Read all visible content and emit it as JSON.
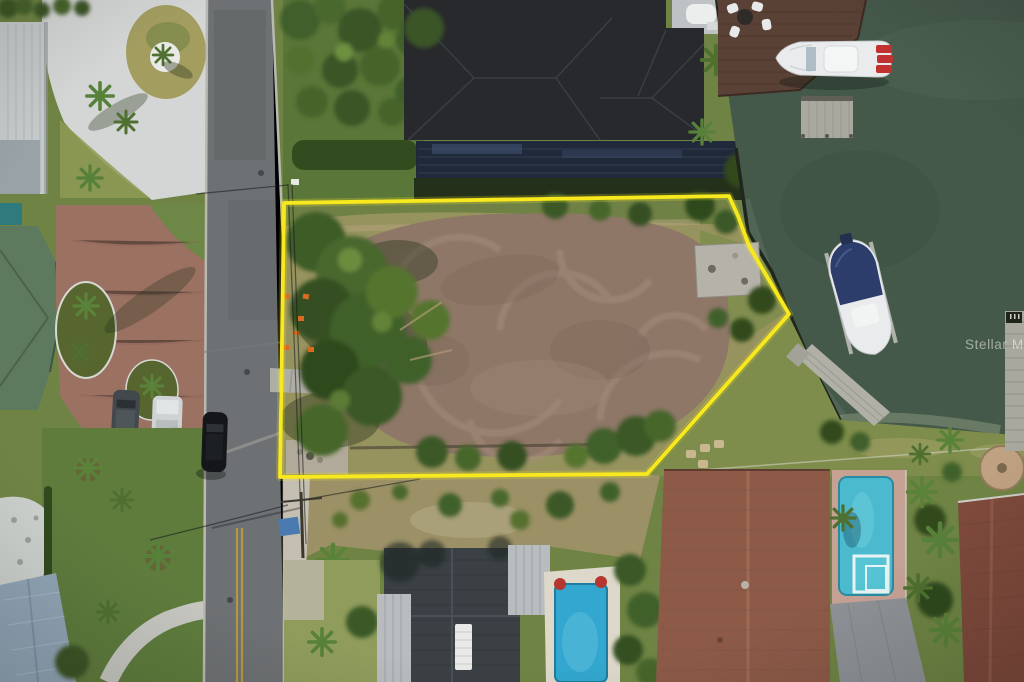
{
  "meta": {
    "description": "Aerial drone photograph of a cleared vacant waterfront lot outlined in yellow, bordered by a residential street on the left and a green canal with docks and boats on the right, surrounded by houses with pools and palm trees."
  },
  "watermark": {
    "text": "Stellar MLS",
    "color": "#ffffff"
  },
  "colors": {
    "boundary": "#f8e81e",
    "water": "#45594b",
    "dirt": "#8e7767",
    "dirt_swirl": "#a58e7c",
    "road": "#6e7173",
    "lane_line": "#b5973c",
    "grass": "#5f7b3d",
    "dry_grass": "#97935f",
    "tree": "#3a5826",
    "charcoal_roof": "#27292c",
    "terracotta_roof": "#8d5a48",
    "terracotta_roof_2": "#7e4a3c",
    "slate_roof": "#92a6b7",
    "green_roof": "#5d7a5e",
    "white_roof": "#c5c9ca",
    "paver_white": "#d4d6d5",
    "paver_brick": "#9b7162",
    "pool_blue": "#33a7cf",
    "pool_turquoise": "#4bb9ce",
    "dock_brown": "#5a4136",
    "dock_gray": "#a8a89e",
    "boat_white": "#e9ebed",
    "boat_cover_blue": "#2c3c6b",
    "engine_red": "#c13130",
    "equipment_orange": "#d96a1f",
    "tarp_blue": "#4a7ab0"
  }
}
